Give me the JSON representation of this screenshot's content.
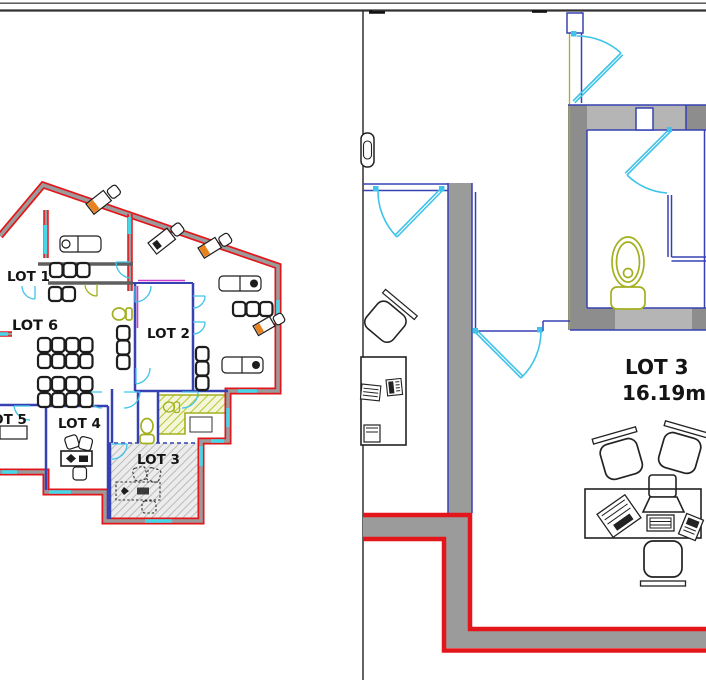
{
  "overview": {
    "description": "small floor plan overview, left panel",
    "lots": [
      {
        "id": "lot-1",
        "label": "LOT 1"
      },
      {
        "id": "lot-2",
        "label": "LOT 2"
      },
      {
        "id": "lot-3",
        "label": "LOT 3"
      },
      {
        "id": "lot-4",
        "label": "LOT 4"
      },
      {
        "id": "lot-5",
        "label": "LOT 5"
      },
      {
        "id": "lot-6",
        "label": "LOT 6"
      }
    ],
    "highlighted_lot": "LOT 3"
  },
  "detail": {
    "description": "enlarged view of LOT 3, right panel",
    "lot_label": "LOT 3",
    "area_label": "16.19m"
  },
  "colors": {
    "exterior_wall_red": "#e3161b",
    "wall_gray": "#9b9b9b",
    "wall_gray_dark": "#8d8d8d",
    "wall_gray_light": "#b5b5b5",
    "interior_wall_blue": "#3642b2",
    "door_cyan": "#3fc3e9",
    "window_cyan": "#47d7e8",
    "fixture_olive": "#a3b01e",
    "accent_orange": "#e8821e",
    "accent_magenta": "#cb3ecb"
  }
}
